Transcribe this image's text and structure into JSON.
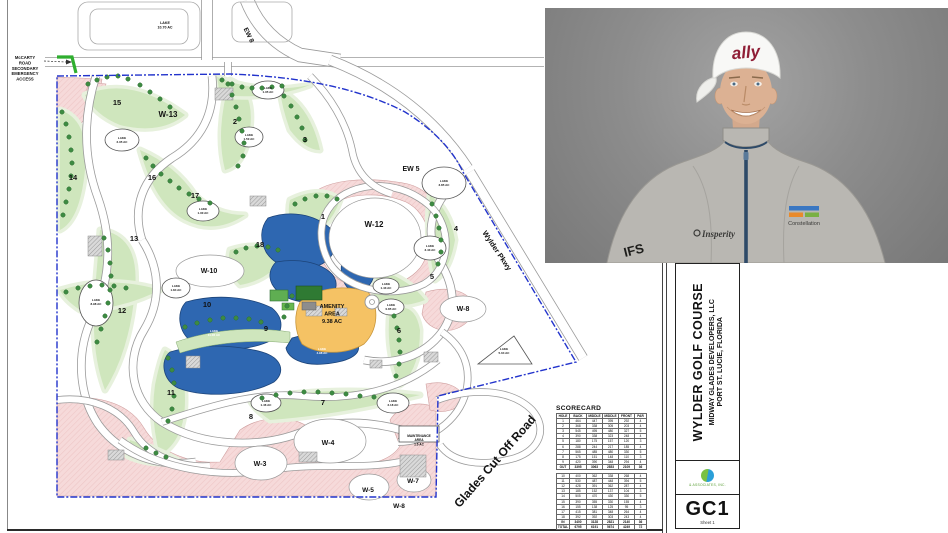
{
  "sheet": {
    "code": "GC1",
    "sheet_label": "Sheet 1"
  },
  "title_block": {
    "project": "WYLDER GOLF COURSE",
    "client": "MIDWAY GLADES DEVELOPERS, LLC",
    "location": "PORT ST. LUCIE, FLORIDA",
    "firm": "& ASSOCIATES, INC."
  },
  "photo": {
    "cap_text": "ally",
    "left_chest_logo": "Insperity",
    "right_chest_logo": "Constellation",
    "sleeve_logo": "IFS"
  },
  "scorecard": {
    "title": "SCORECARD",
    "headers": [
      "HOLE",
      "BACK",
      "MIDDLE",
      "MIDDLE",
      "FRONT",
      "PAR"
    ],
    "front_nine": [
      [
        1,
        464,
        447,
        395,
        292,
        4
      ],
      [
        2,
        368,
        338,
        305,
        203,
        4
      ],
      [
        3,
        545,
        495,
        480,
        327,
        5
      ],
      [
        4,
        390,
        338,
        323,
        248,
        4
      ],
      [
        5,
        180,
        175,
        157,
        120,
        3
      ],
      [
        6,
        288,
        244,
        217,
        185,
        4
      ],
      [
        7,
        565,
        485,
        480,
        330,
        5
      ],
      [
        8,
        175,
        151,
        148,
        110,
        3
      ],
      [
        9,
        420,
        390,
        348,
        294,
        4
      ]
    ],
    "out_row": [
      "OUT",
      3395,
      3063,
      2853,
      2109,
      36
    ],
    "back_nine": [
      [
        10,
        400,
        362,
        338,
        268,
        4
      ],
      [
        11,
        530,
        487,
        448,
        394,
        5
      ],
      [
        12,
        428,
        391,
        362,
        287,
        4
      ],
      [
        13,
        185,
        152,
        137,
        104,
        3
      ],
      [
        14,
        505,
        470,
        430,
        330,
        5
      ],
      [
        15,
        390,
        355,
        330,
        155,
        4
      ],
      [
        16,
        155,
        138,
        125,
        95,
        3
      ],
      [
        17,
        415,
        381,
        348,
        264,
        4
      ],
      [
        18,
        392,
        392,
        303,
        243,
        4
      ]
    ],
    "in_row": [
      "IN",
      3400,
      3128,
      2821,
      2140,
      36
    ],
    "total_row": [
      "TOTAL",
      6795,
      6191,
      5674,
      4249,
      72
    ]
  },
  "map": {
    "labels": [
      {
        "n": "area-w13",
        "t": "W-13",
        "x": 168,
        "y": 117,
        "s": 8
      },
      {
        "n": "area-w12",
        "t": "W-12",
        "x": 374,
        "y": 227,
        "s": 8
      },
      {
        "n": "area-w10",
        "t": "W-10",
        "x": 209,
        "y": 273,
        "s": 7
      },
      {
        "n": "area-w8",
        "t": "W-8",
        "x": 463,
        "y": 311,
        "s": 7
      },
      {
        "n": "area-w4",
        "t": "W-4",
        "x": 328,
        "y": 445,
        "s": 7
      },
      {
        "n": "area-w3",
        "t": "W-3",
        "x": 260,
        "y": 466,
        "s": 7
      },
      {
        "n": "area-w5",
        "t": "W-5",
        "x": 368,
        "y": 492,
        "s": 6.5
      },
      {
        "n": "area-w7",
        "t": "W-7",
        "x": 413,
        "y": 483,
        "s": 6.5
      },
      {
        "n": "area-w8-south",
        "t": "W-8",
        "x": 399,
        "y": 508,
        "s": 6.5
      },
      {
        "n": "amenity-area",
        "lines": [
          "AMENITY",
          "AREA",
          "9.38 AC"
        ],
        "x": 332,
        "y": 308,
        "s": 5.5,
        "lh": 7.5
      },
      {
        "n": "maintenance-area",
        "lines": [
          "MAINTENANCE",
          "AREA",
          "1.6 AC"
        ],
        "x": 419,
        "y": 437,
        "s": 3.2,
        "lh": 4.2
      },
      {
        "n": "road-ew5",
        "t": "EW 5",
        "x": 411,
        "y": 171,
        "s": 7
      },
      {
        "n": "road-ew8",
        "t": "EW 8",
        "x": 247,
        "y": 36,
        "s": 6.5,
        "r": 64
      },
      {
        "n": "road-wylder-pkwy",
        "t": "Wylder Pkwy",
        "x": 495,
        "y": 252,
        "s": 7.5,
        "r": 56
      },
      {
        "n": "road-glades-cutoff",
        "t": "Glades Cut Off Road",
        "x": 498,
        "y": 464,
        "s": 12,
        "r": -49
      },
      {
        "n": "mccarty-access-note",
        "lines": [
          "McCARTY",
          "ROAD",
          "SECONDARY",
          "EMERGENCY",
          "ACCESS"
        ],
        "x": 25,
        "y": 59,
        "s": 4.2,
        "lh": 5.4
      },
      {
        "n": "lake-10-70",
        "lines": [
          "LAKE",
          "10.70 AC"
        ],
        "x": 165,
        "y": 24,
        "s": 3.6,
        "lh": 4.6
      },
      {
        "n": "lake-1-35",
        "lines": [
          "LAKE",
          "1.35 AC"
        ],
        "x": 268,
        "y": 89,
        "s": 3,
        "lh": 3.8
      },
      {
        "n": "lake-2-35",
        "lines": [
          "LAKE",
          "2.35 AC"
        ],
        "x": 122,
        "y": 139,
        "s": 3,
        "lh": 3.8
      },
      {
        "n": "lake-1-50",
        "lines": [
          "LAKE",
          "1.50 AC"
        ],
        "x": 249,
        "y": 136,
        "s": 3,
        "lh": 3.8
      },
      {
        "n": "lake-1-30",
        "lines": [
          "LAKE",
          "1.30 AC"
        ],
        "x": 203,
        "y": 210,
        "s": 3,
        "lh": 3.8
      },
      {
        "n": "lake-1-84",
        "lines": [
          "LAKE",
          "1.84 AC"
        ],
        "x": 176,
        "y": 287,
        "s": 3,
        "lh": 3.8
      },
      {
        "n": "lake-8-98",
        "lines": [
          "LAKE",
          "8.98 AC"
        ],
        "x": 96,
        "y": 301,
        "s": 3,
        "lh": 3.8
      },
      {
        "n": "lake-11-06",
        "lines": [
          "LAKE",
          "11.06 AC"
        ],
        "x": 214,
        "y": 332,
        "s": 3,
        "lh": 3.8,
        "f": "#ffffff"
      },
      {
        "n": "lake-4-98",
        "lines": [
          "LAKE",
          "4.98 AC"
        ],
        "x": 322,
        "y": 350,
        "s": 3,
        "lh": 3.8,
        "f": "#ffffff"
      },
      {
        "n": "lake-3-85",
        "lines": [
          "LAKE",
          "3.85 AC"
        ],
        "x": 444,
        "y": 182,
        "s": 3,
        "lh": 3.8
      },
      {
        "n": "lake-3-43",
        "lines": [
          "LAKE",
          "3.43 AC"
        ],
        "x": 430,
        "y": 247,
        "s": 3,
        "lh": 3.8
      },
      {
        "n": "lake-1-43",
        "lines": [
          "LAKE",
          "1.43 AC"
        ],
        "x": 386,
        "y": 285,
        "s": 3,
        "lh": 3.8
      },
      {
        "n": "lake-0-85",
        "lines": [
          "LAKE",
          "0.85 AC"
        ],
        "x": 391,
        "y": 306,
        "s": 3,
        "lh": 3.8
      },
      {
        "n": "lake-5-04",
        "lines": [
          "LAKE",
          "5.04 AC"
        ],
        "x": 504,
        "y": 350,
        "s": 3,
        "lh": 3.8
      },
      {
        "n": "lake-2-18",
        "lines": [
          "LAKE",
          "2.18 AC"
        ],
        "x": 393,
        "y": 402,
        "s": 3,
        "lh": 3.8
      },
      {
        "n": "lake-1-46",
        "lines": [
          "LAKE",
          "1.46 AC"
        ],
        "x": 266,
        "y": 402,
        "s": 3,
        "lh": 3.8
      },
      {
        "n": "hole-1",
        "t": "1",
        "x": 323,
        "y": 219,
        "s": 7.5
      },
      {
        "n": "hole-2",
        "t": "2",
        "x": 235,
        "y": 124,
        "s": 7.5
      },
      {
        "n": "hole-3",
        "t": "3",
        "x": 305,
        "y": 142,
        "s": 7.5
      },
      {
        "n": "hole-4",
        "t": "4",
        "x": 456,
        "y": 231,
        "s": 7.5
      },
      {
        "n": "hole-5",
        "t": "5",
        "x": 432,
        "y": 279,
        "s": 7.5
      },
      {
        "n": "hole-6",
        "t": "6",
        "x": 399,
        "y": 333,
        "s": 7.5
      },
      {
        "n": "hole-7",
        "t": "7",
        "x": 323,
        "y": 405,
        "s": 7.5
      },
      {
        "n": "hole-8",
        "t": "8",
        "x": 251,
        "y": 419,
        "s": 7.5
      },
      {
        "n": "hole-9",
        "t": "9",
        "x": 266,
        "y": 331,
        "s": 7.5
      },
      {
        "n": "hole-10",
        "t": "10",
        "x": 207,
        "y": 307,
        "s": 7.5
      },
      {
        "n": "hole-11",
        "t": "11",
        "x": 171,
        "y": 395,
        "s": 7.5
      },
      {
        "n": "hole-12",
        "t": "12",
        "x": 122,
        "y": 313,
        "s": 7.5
      },
      {
        "n": "hole-13",
        "t": "13",
        "x": 134,
        "y": 241,
        "s": 7.5
      },
      {
        "n": "hole-14",
        "t": "14",
        "x": 73,
        "y": 180,
        "s": 7.5
      },
      {
        "n": "hole-15",
        "t": "15",
        "x": 117,
        "y": 105,
        "s": 7.5
      },
      {
        "n": "hole-16",
        "t": "16",
        "x": 152,
        "y": 180,
        "s": 7.5
      },
      {
        "n": "hole-17",
        "t": "17",
        "x": 195,
        "y": 198,
        "s": 7.5
      },
      {
        "n": "hole-18",
        "t": "18",
        "x": 260,
        "y": 247,
        "s": 7.5
      }
    ]
  },
  "colors": {
    "boundary_blue": "#2233cc",
    "lake_blue": "#2e67b1",
    "fairway_green": "#cfe6bd",
    "tree_green": "#3d8b42",
    "amenity_orange": "#f5c264",
    "parcel_pink": "#f6dada",
    "access_marker_green": "#2fae2f"
  }
}
